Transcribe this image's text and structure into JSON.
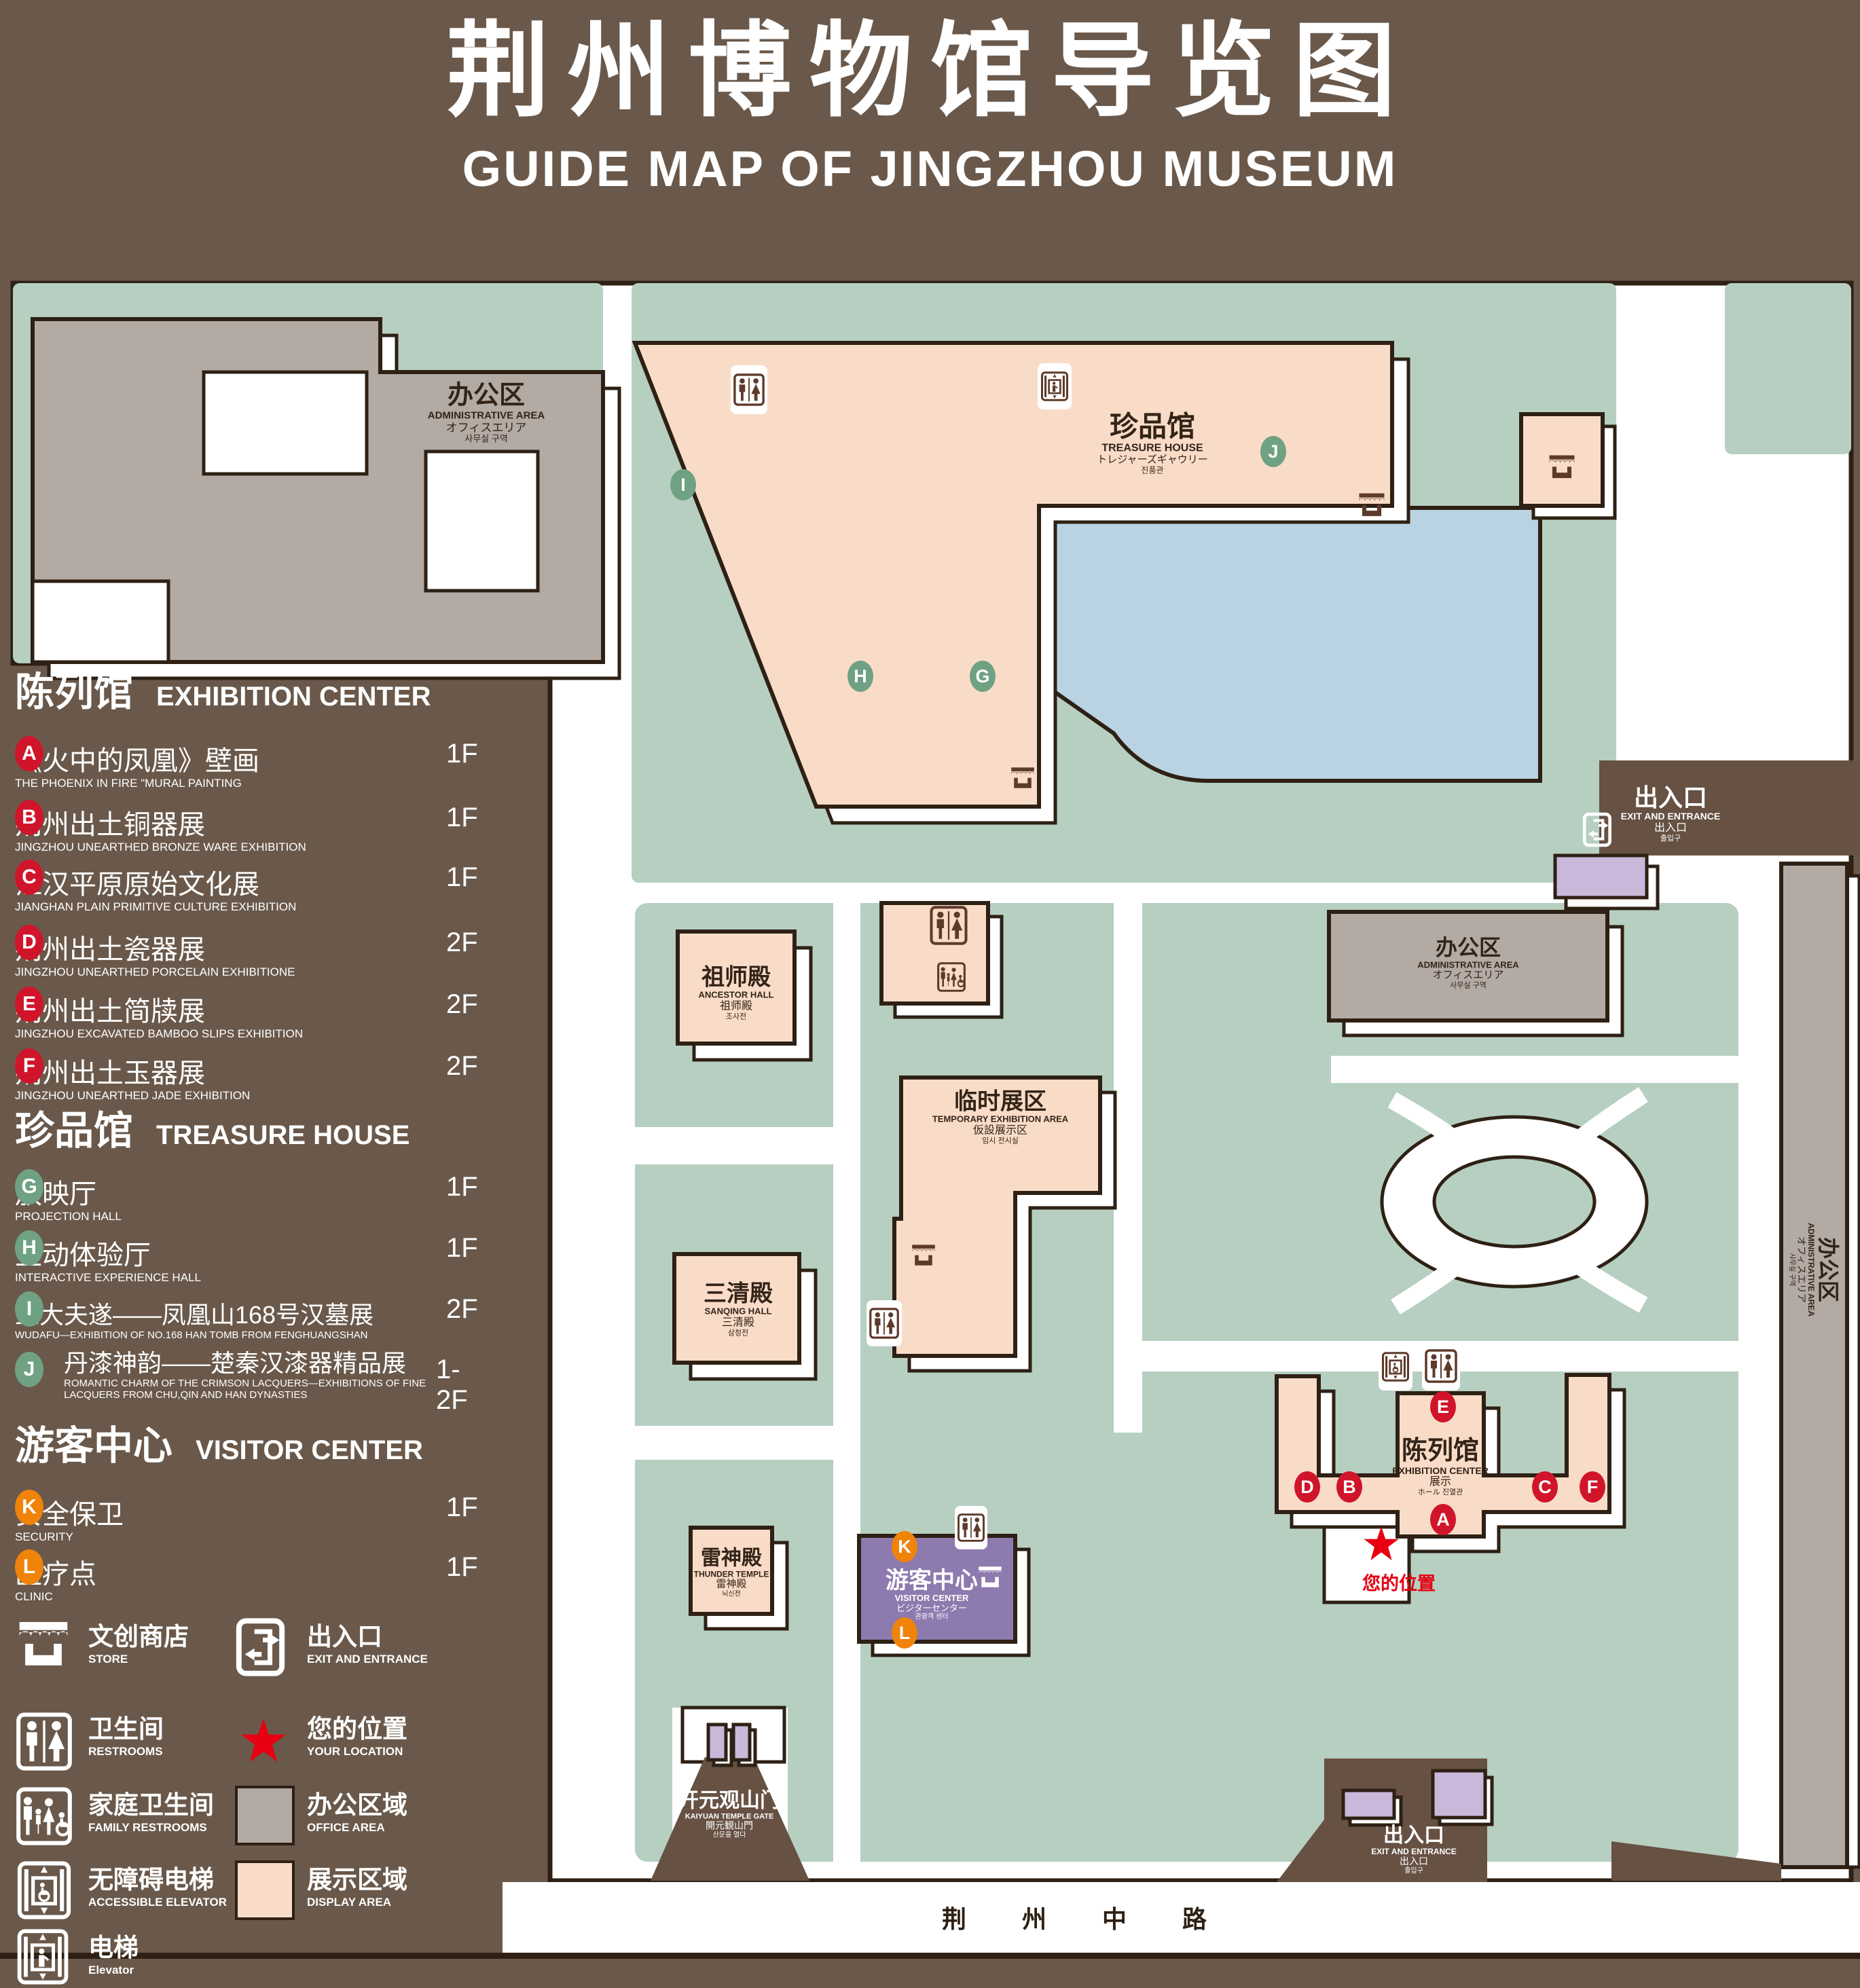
{
  "title": {
    "zh": "荆州博物馆导览图",
    "en": "GUIDE MAP OF JINGZHOU MUSEUM"
  },
  "colors": {
    "background": "#6a594b",
    "ground_green": "#b6cfc1",
    "display_area": "#f9dcc8",
    "office_area": "#b3aaa4",
    "visitor_center": "#8d7aae",
    "pond": "#b9d3e2",
    "marker_red": "#d0152b",
    "marker_green": "#6fa183",
    "marker_orange": "#f0830a",
    "location_red": "#e60012",
    "outline": "#2e2014"
  },
  "legend": {
    "sections": [
      {
        "zh": "陈列馆",
        "en": "EXHIBITION CENTER",
        "items": [
          {
            "key": "A",
            "zh": "《火中的凤凰》壁画",
            "en": "THE PHOENIX IN FIRE \"MURAL PAINTING",
            "floor": "1F"
          },
          {
            "key": "B",
            "zh": "荆州出土铜器展",
            "en": "JINGZHOU UNEARTHED BRONZE WARE EXHIBITION",
            "floor": "1F"
          },
          {
            "key": "C",
            "zh": "江汉平原原始文化展",
            "en": "JIANGHAN PLAIN PRIMITIVE CULTURE EXHIBITION",
            "floor": "1F"
          },
          {
            "key": "D",
            "zh": "荆州出土瓷器展",
            "en": "JINGZHOU UNEARTHED PORCELAIN EXHIBITIONE",
            "floor": "2F"
          },
          {
            "key": "E",
            "zh": "荆州出土简牍展",
            "en": "JINGZHOU EXCAVATED BAMBOO SLIPS EXHIBITION",
            "floor": "2F"
          },
          {
            "key": "F",
            "zh": "荆州出土玉器展",
            "en": "JINGZHOU UNEARTHED JADE EXHIBITION",
            "floor": "2F"
          }
        ]
      },
      {
        "zh": "珍品馆",
        "en": "TREASURE HOUSE",
        "items": [
          {
            "key": "G",
            "zh": "放映厅",
            "en": "PROJECTION HALL",
            "floor": "1F"
          },
          {
            "key": "H",
            "zh": "互动体验厅",
            "en": "INTERACTIVE EXPERIENCE HALL",
            "floor": "1F"
          },
          {
            "key": "I",
            "zh": "五大夫遂——凤凰山168号汉墓展",
            "en": "WUDAFU—EXHIBITION OF NO.168 HAN TOMB FROM FENGHUANGSHAN",
            "floor": "2F"
          },
          {
            "key": "J",
            "zh": "丹漆神韵——楚秦汉漆器精品展",
            "en": "ROMANTIC CHARM OF THE CRIMSON LACQUERS—EXHIBITIONS OF FINE LACQUERS FROM CHU,QIN AND HAN DYNASTIES",
            "floor": "1-2F"
          }
        ]
      },
      {
        "zh": "游客中心",
        "en": "VISITOR CENTER",
        "items": [
          {
            "key": "K",
            "zh": "安全保卫",
            "en": "SECURITY",
            "floor": "1F"
          },
          {
            "key": "L",
            "zh": "医疗点",
            "en": "CLINIC",
            "floor": "1F"
          }
        ]
      }
    ],
    "symbols": [
      {
        "icon": "store-icon",
        "zh": "文创商店",
        "en": "STORE"
      },
      {
        "icon": "exit-icon",
        "zh": "出入口",
        "en": "EXIT AND ENTRANCE"
      },
      {
        "icon": "restroom-icon",
        "zh": "卫生间",
        "en": "RESTROOMS"
      },
      {
        "icon": "location-star-icon",
        "zh": "您的位置",
        "en": "YOUR LOCATION"
      },
      {
        "icon": "family-restroom-icon",
        "zh": "家庭卫生间",
        "en": "FAMILY RESTROOMS"
      },
      {
        "icon": "office-area-swatch",
        "zh": "办公区域",
        "en": "OFFICE AREA"
      },
      {
        "icon": "accessible-elevator-icon",
        "zh": "无障碍电梯",
        "en": "ACCESSIBLE ELEVATOR"
      },
      {
        "icon": "display-area-swatch",
        "zh": "展示区域",
        "en": "DISPLAY AREA"
      },
      {
        "icon": "elevator-icon",
        "zh": "电梯",
        "en": "Elevator"
      }
    ]
  },
  "map": {
    "buildings": {
      "admin_topleft": {
        "l1": "办公区",
        "l2": "ADMINISTRATIVE AREA",
        "l3": "オフィスエリア",
        "l4": "사무실 구역"
      },
      "treasure_house": {
        "l1": "珍品馆",
        "l2": "TREASURE HOUSE",
        "l3": "トレジャーズギャウリー",
        "l4": "진품관"
      },
      "ancestor_hall": {
        "l1": "祖师殿",
        "l2": "ANCESTOR HALL",
        "l3": "祖师殿",
        "l4": "조사전"
      },
      "temporary_area": {
        "l1": "临时展区",
        "l2": "TEMPORARY EXHIBITION AREA",
        "l3": "仮設展示区",
        "l4": "임시 전시실"
      },
      "admin_right": {
        "l1": "办公区",
        "l2": "ADMINISTRATIVE AREA",
        "l3": "オフィスエリア",
        "l4": "사무실 구역"
      },
      "admin_strip": {
        "l1": "办公区",
        "l2": "ADMINISTRATIVE AREA",
        "l3": "オフィスエリア",
        "l4": "사무실 구역"
      },
      "sanqing_hall": {
        "l1": "三清殿",
        "l2": "SANQING HALL",
        "l3": "三清殿",
        "l4": "삼청전"
      },
      "thunder_temple": {
        "l1": "雷神殿",
        "l2": "THUNDER TEMPLE",
        "l3": "雷神殿",
        "l4": "뇌신전"
      },
      "visitor_center": {
        "l1": "游客中心",
        "l2": "VISITOR CENTER",
        "l3": "ビジターセンター",
        "l4": "관광객 센터"
      },
      "exhibition_center": {
        "l1": "陈列馆",
        "l2": "EXHIBITION CENTER",
        "l3": "展示",
        "l4": "ホール 진열관"
      },
      "gate": {
        "l1": "开元观山门",
        "l2": "KAIYUAN TEMPLE GATE",
        "l3": "開元観山門",
        "l4": "산문을 열다"
      },
      "exit_top": {
        "l1": "出入口",
        "l2": "EXIT AND ENTRANCE",
        "l3": "出入口",
        "l4": "출입구"
      },
      "exit_bottom": {
        "l1": "出入口",
        "l2": "EXIT AND ENTRANCE",
        "l3": "出入口",
        "l4": "출입구"
      }
    },
    "your_location": "您的位置",
    "road": "荆 州 中 路"
  }
}
